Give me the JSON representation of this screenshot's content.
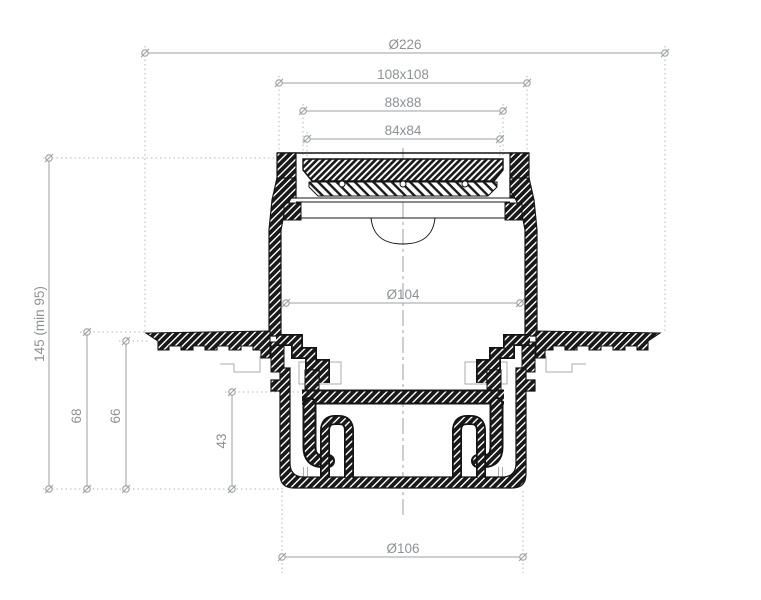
{
  "drawing": {
    "title": "floor-drain-cross-section",
    "dimensions": {
      "top_diameter": "Ø226",
      "frame_outer": "108x108",
      "grate_outer": "88x88",
      "grate_inner": "84x84",
      "body_diameter": "Ø104",
      "outlet_diameter": "Ø106",
      "height_total": "145 (min 95)",
      "height_left": "68",
      "height_right": "66",
      "height_trap": "43"
    },
    "colors": {
      "outline_black": "#141414",
      "dimension_gray": "#9aa0a3",
      "label_gray": "#8d9296",
      "background": "#ffffff"
    }
  }
}
